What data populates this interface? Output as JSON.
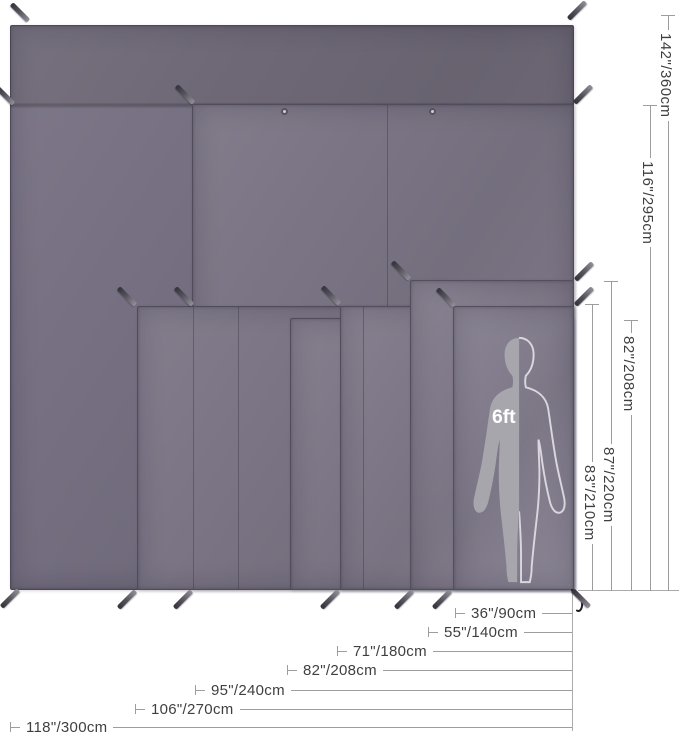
{
  "scale_figure": {
    "height_label": "6ft"
  },
  "dimensions": {
    "vertical": [
      {
        "label": "142\"/360cm"
      },
      {
        "label": "116\"/295cm"
      },
      {
        "label": "82\"/208cm"
      },
      {
        "label": "87\"/220cm"
      },
      {
        "label": "83\"/210cm"
      }
    ],
    "horizontal": [
      {
        "label": "36\"/90cm"
      },
      {
        "label": "55\"/140cm"
      },
      {
        "label": "71\"/180cm"
      },
      {
        "label": "82\"/208cm"
      },
      {
        "label": "95\"/240cm"
      },
      {
        "label": "106\"/270cm"
      },
      {
        "label": "118\"/300cm"
      }
    ]
  },
  "tarps": [
    {
      "name": "tarp-118x142",
      "width_label": "118\"/300cm",
      "height_label": "142\"/360cm"
    },
    {
      "name": "tarp-95x116",
      "width_label": "95\"/240cm",
      "height_label": "116\"/295cm"
    },
    {
      "name": "tarp-106x83",
      "width_label": "106\"/270cm",
      "height_label": "83\"/210cm"
    },
    {
      "name": "tarp-82x82",
      "width_label": "82\"/208cm",
      "height_label": "82\"/208cm"
    },
    {
      "name": "tarp-71x83",
      "width_label": "71\"/180cm",
      "height_label": "83\"/210cm"
    },
    {
      "name": "tarp-55x87",
      "width_label": "55\"/140cm",
      "height_label": "87\"/220cm"
    },
    {
      "name": "tarp-36x83",
      "width_label": "36\"/90cm",
      "height_label": "83\"/210cm"
    }
  ],
  "colors": {
    "tarp_dark_band": "#6e6876",
    "tarp_base": "#7a7484",
    "tarp_front": "#837d8d",
    "figure_fill": "#a8a6ad",
    "figure_outline": "#d9d6de",
    "label_text": "#3f3f3f",
    "dim_line": "#9d9d9d"
  },
  "decor": {
    "stakes": [
      [
        20,
        13,
        45
      ],
      [
        577,
        11,
        -45
      ],
      [
        5,
        96,
        45
      ],
      [
        185,
        95,
        45
      ],
      [
        583,
        95,
        -45
      ],
      [
        401,
        271,
        45
      ],
      [
        584,
        272,
        -45
      ],
      [
        127,
        297,
        45
      ],
      [
        184,
        297,
        45
      ],
      [
        331,
        296,
        45
      ],
      [
        446,
        298,
        45
      ],
      [
        584,
        297,
        -45
      ],
      [
        10,
        599,
        -45
      ],
      [
        127,
        600,
        -45
      ],
      [
        183,
        600,
        -45
      ],
      [
        330,
        600,
        -45
      ],
      [
        404,
        600,
        -45
      ],
      [
        442,
        600,
        -45
      ],
      [
        581,
        599,
        45
      ]
    ]
  }
}
